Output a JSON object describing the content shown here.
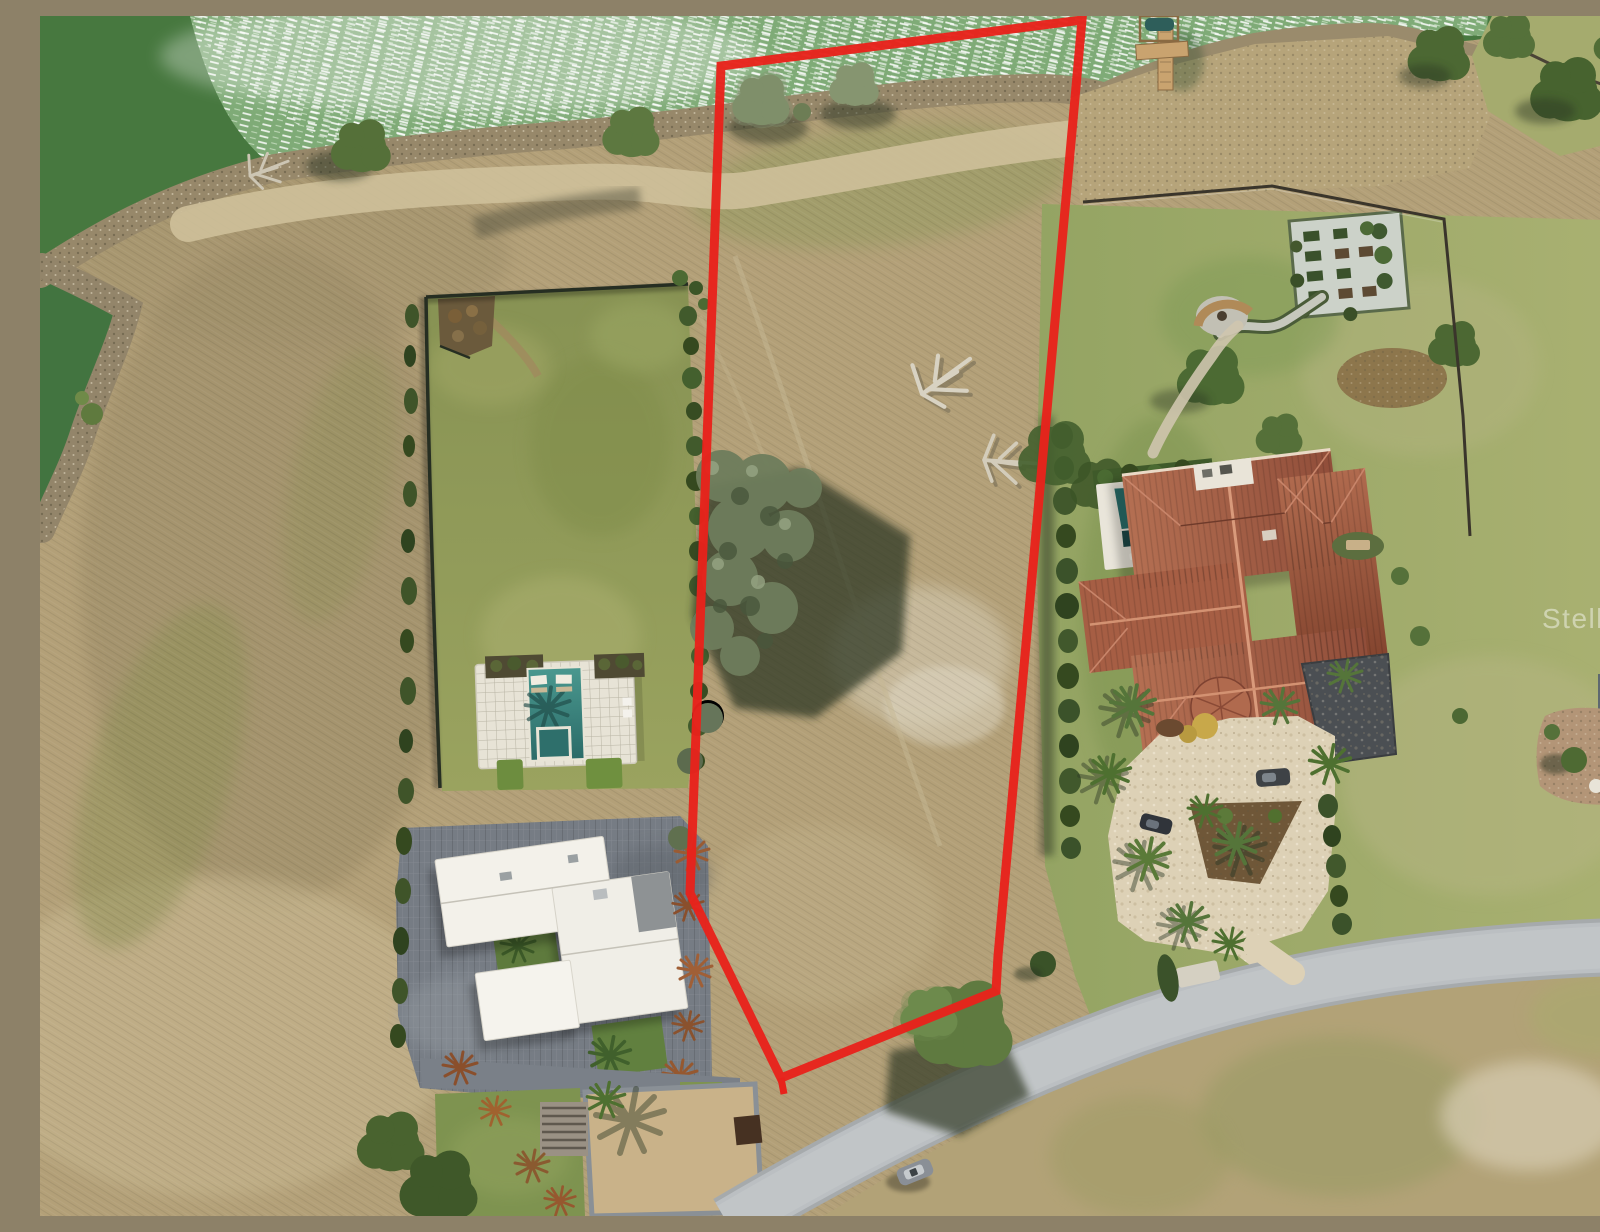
{
  "image": {
    "kind": "aerial-drone-photo",
    "subject": "Aerial real-estate photo: vacant waterfront lot outlined in red between a modern white home and a Mediterranean tile-roof estate on a lake",
    "width": 1600,
    "height": 1200
  },
  "watermark": {
    "text": "Stellar MLS",
    "color": "#ffffff"
  },
  "boundary": {
    "label": "red outline of listed vacant lot",
    "color": "#e8221b",
    "stroke_width": 9,
    "points": [
      [
        681,
        50
      ],
      [
        1042,
        4
      ],
      [
        958,
        940
      ],
      [
        956,
        975
      ],
      [
        741,
        1062
      ],
      [
        650,
        877
      ]
    ],
    "stub": [
      [
        741,
        1062
      ],
      [
        744,
        1078
      ]
    ]
  },
  "scene": {
    "lake": {
      "label": "lake with wind sparkle",
      "water_color": "#47783f",
      "sparkle_color": "#cfe6c8"
    },
    "vacant_lot": {
      "label": "outlined vacant lot, dry grass with large oak tree",
      "ground_color": "#b4a076"
    },
    "left_home": {
      "label": "modern white flat-roof home with pool and fenced lawn",
      "roof_color": "#f2efe8",
      "pool_color": "#3a8a84",
      "lawn_color": "#929c58"
    },
    "right_estate": {
      "label": "Mediterranean estate with tile roof, pool, circular paver drive",
      "roof_color": "#a65e43",
      "pool_color": "#2e7370",
      "driveway_color": "#ddd1b6"
    },
    "garden": {
      "label": "fenced raised-bed garden with winding path"
    },
    "dock": {
      "label": "wooden T-dock with boat lift"
    },
    "road": {
      "label": "curving residential street",
      "color": "#bbbfc2"
    },
    "car": {
      "label": "car parked on street"
    },
    "neighbor_home": {
      "label": "neighboring home at right edge"
    }
  },
  "colors": {
    "field_tan": "#b3a078",
    "shore_scrub": "#97886a",
    "hedge_green": "#3f5429",
    "fence_dark": "#2c332b",
    "tree_shadow": "#2c3424",
    "pale_sand": "#d8d0bb"
  }
}
